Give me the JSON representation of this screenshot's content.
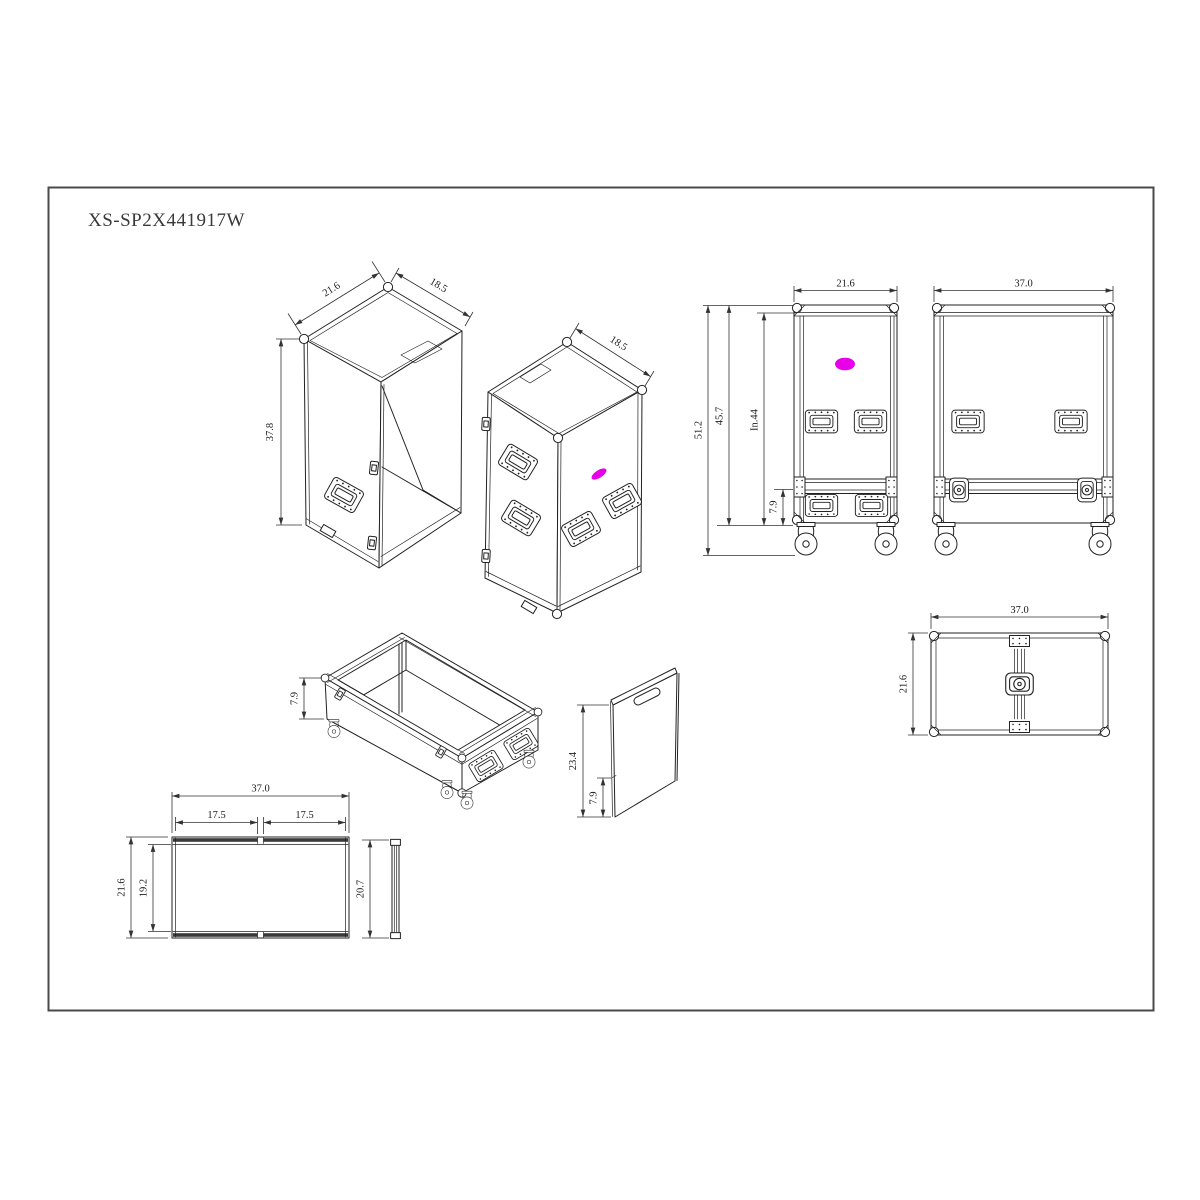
{
  "title": "XS-SP2X441917W",
  "colors": {
    "line": "#222222",
    "dim": "#333333",
    "highlight": "#e800e8",
    "background": "#ffffff"
  },
  "views": {
    "lid_iso": {
      "dims": {
        "width": "21.6",
        "depth": "18.5",
        "height": "37.8"
      }
    },
    "case_iso": {
      "dims": {
        "depth": "18.5"
      }
    },
    "front": {
      "dims": {
        "width": "21.6",
        "total_height": "51.2",
        "body_height": "45.7",
        "inner_height": "In.44",
        "lid_height": "7.9"
      }
    },
    "side": {
      "dims": {
        "width": "37.0"
      }
    },
    "top": {
      "dims": {
        "width": "37.0",
        "depth": "21.6"
      }
    },
    "tray_iso": {
      "dims": {
        "height": "7.9"
      }
    },
    "divider": {
      "dims": {
        "height": "23.4",
        "bottom_height": "7.9"
      }
    },
    "tray_plan": {
      "dims": {
        "width": "37.0",
        "left_half": "17.5",
        "right_half": "17.5",
        "depth": "21.6",
        "inner_depth": "19.2"
      }
    },
    "panel_profile": {
      "dims": {
        "height": "20.7"
      }
    }
  }
}
